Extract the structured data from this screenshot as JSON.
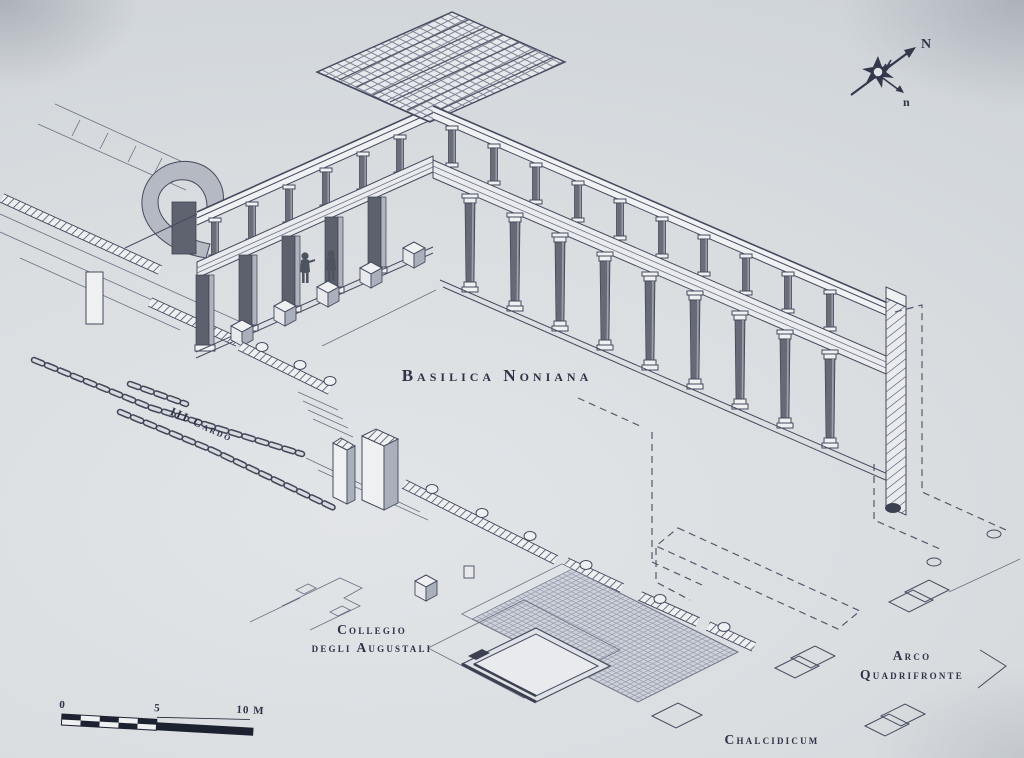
{
  "title": "Axonometric reconstruction drawing",
  "labels": {
    "basilica": "Basilica Noniana",
    "cardo": "III Cardo",
    "collegio_line1": "Collegio",
    "collegio_line2": "degli Augustali",
    "arco_line1": "Arco",
    "arco_line2": "Quadrifronte",
    "chalcidicum": "Chalcidicum"
  },
  "compass": {
    "north": "N",
    "north_small": "n"
  },
  "scale_bar": {
    "zero": "0",
    "five": "5",
    "ten": "10 M"
  },
  "colors": {
    "paper": "#d8dce0",
    "ink": "#454a5e",
    "column_dark": "#666a76",
    "label_ink": "#2e3347"
  }
}
